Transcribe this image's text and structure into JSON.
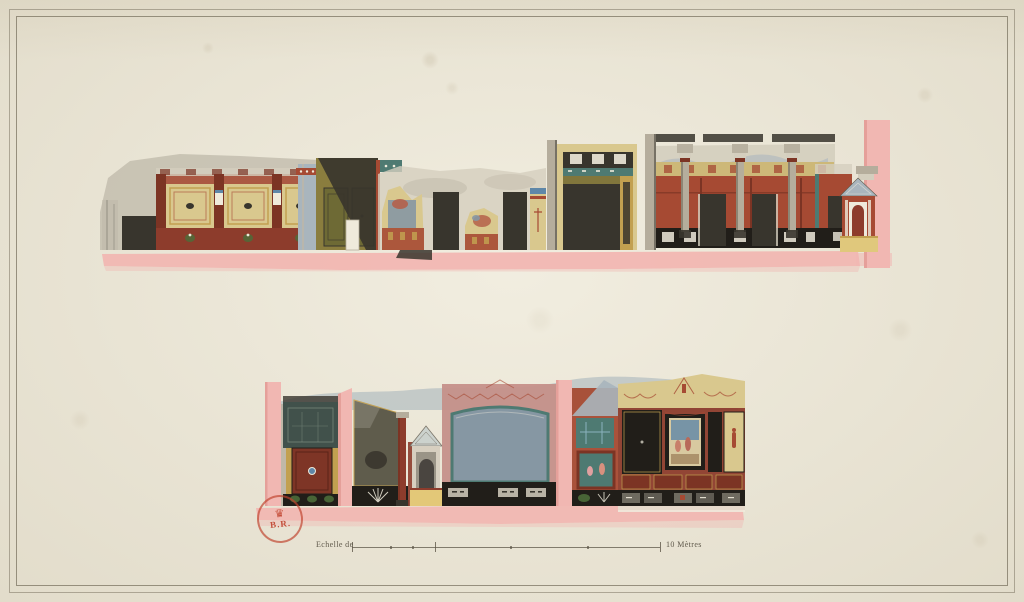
{
  "plate": {
    "scale_bar": {
      "label": "Echelle de",
      "end_label": "10 Mètres"
    },
    "stamp": {
      "letters": "B.R."
    }
  },
  "icons": {
    "crown": "♛"
  },
  "palette": {
    "paper": "#eae5d5",
    "line": "#8f8874",
    "ink": "#5f584a",
    "pink": "#f1b7b2",
    "pink-deep": "#e29a94",
    "red": "#a64a33",
    "red-dark": "#7c3424",
    "maroon": "#8d3c2c",
    "yellow": "#d9c88e",
    "yellow-deep": "#c2a050",
    "olive": "#8a7d3e",
    "dark": "#38352d",
    "black": "#211e19",
    "wash": "#bdb7a7",
    "wash-light": "#d4cebe",
    "sky": "#a9b5bd",
    "teal": "#4e7a72",
    "teal-dark": "#41514b",
    "panel-blue": "#8697a3",
    "mauve": "#c5908a",
    "white": "#efeadb",
    "blue": "#5f87a8",
    "column": "#b5ad9c",
    "green": "#4d6b3a",
    "umber": "#5f5c4c",
    "stamp-red": "#c0432e"
  }
}
